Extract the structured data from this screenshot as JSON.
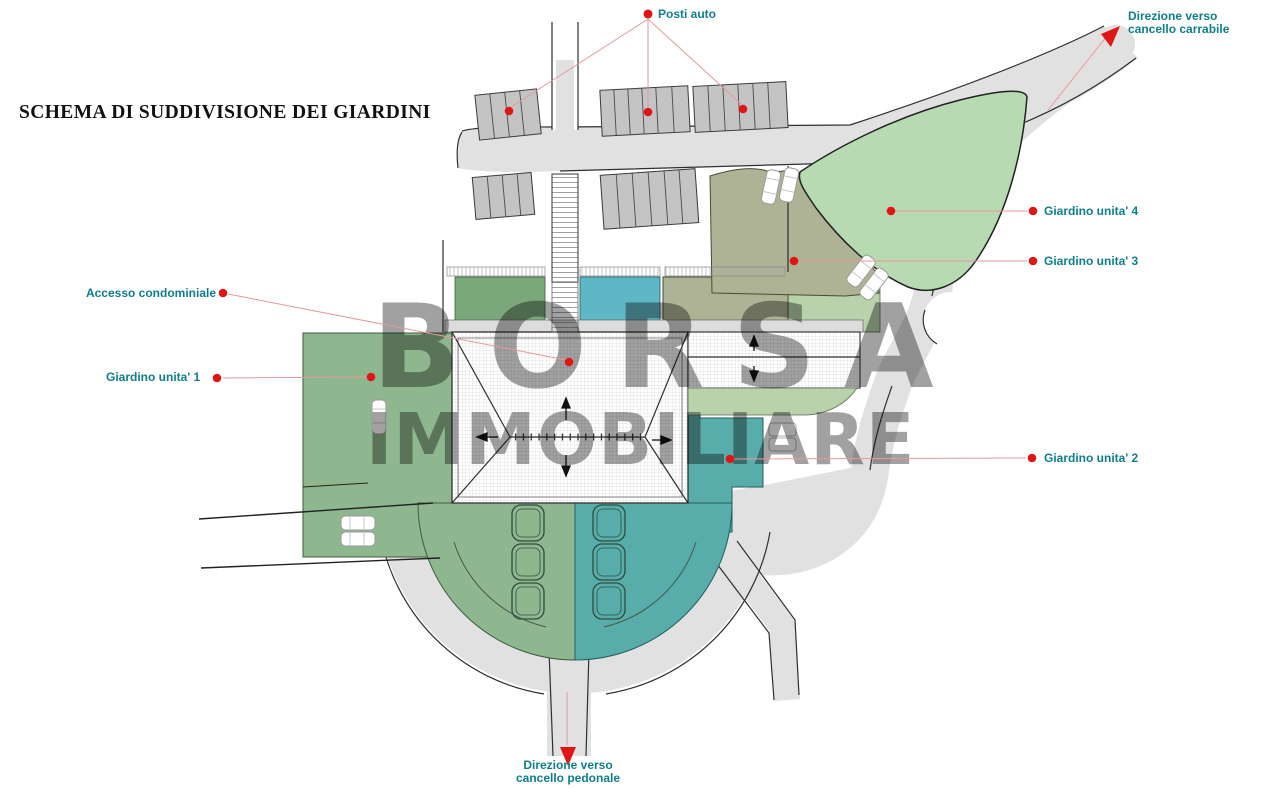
{
  "title": "SCHEMA DI SUDDIVISIONE DEI GIARDINI",
  "watermark": {
    "line1": "BORSA",
    "line2": "IMMOBILIARE"
  },
  "labels": {
    "posti_auto": "Posti auto",
    "direzione_carrabile_1": "Direzione verso",
    "direzione_carrabile_2": "cancello carrabile",
    "giardino_4": "Giardino unita' 4",
    "giardino_3": "Giardino unita' 3",
    "giardino_2": "Giardino unita' 2",
    "giardino_1": "Giardino unita' 1",
    "accesso": "Accesso condominiale",
    "direzione_pedonale_1": "Direzione verso",
    "direzione_pedonale_2": "cancello pedonale"
  },
  "colors": {
    "label_text": "#0e7f8b",
    "marker_red": "#e01616",
    "leader_line": "#e59a9a",
    "garden1": "#8fb78f",
    "garden1_dark": "#7aa87b",
    "garden2": "#58aca9",
    "garden2_cyan": "#5fb6c4",
    "garden3": "#adb394",
    "garden3_sage": "#bad2ac",
    "garden4": "#b7dab2",
    "road": "#e1e1e1",
    "parking": "#c4c4c4",
    "watermark": "#999999",
    "outline": "#2f2f2f"
  }
}
